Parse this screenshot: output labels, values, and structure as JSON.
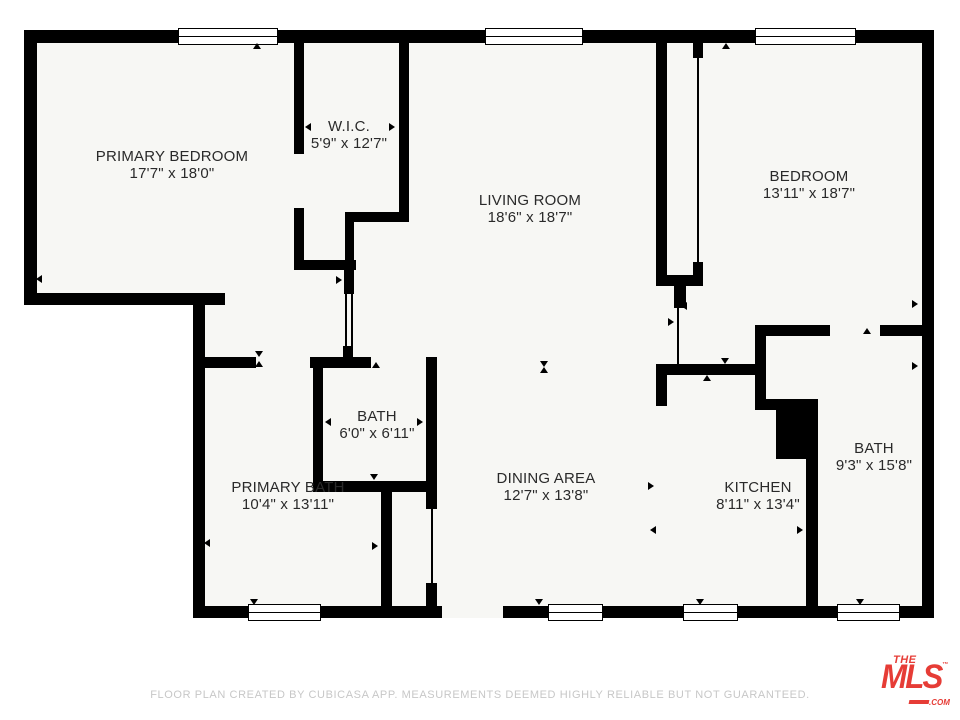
{
  "floorplan": {
    "rooms": [
      {
        "name": "PRIMARY BEDROOM",
        "dims": "17'7\" x 18'0\""
      },
      {
        "name": "W.I.C.",
        "dims": "5'9\" x 12'7\""
      },
      {
        "name": "LIVING ROOM",
        "dims": "18'6\" x 18'7\""
      },
      {
        "name": "BEDROOM",
        "dims": "13'11\" x 18'7\""
      },
      {
        "name": "BATH",
        "dims": "6'0\" x 6'11\""
      },
      {
        "name": "PRIMARY BATH",
        "dims": "10'4\" x 13'11\""
      },
      {
        "name": "DINING AREA",
        "dims": "12'7\" x 13'8\""
      },
      {
        "name": "KITCHEN",
        "dims": "8'11\" x 13'4\""
      },
      {
        "name": "BATH",
        "dims": "9'3\" x 15'8\""
      }
    ],
    "footer": "FLOOR PLAN CREATED BY CUBICASA APP. MEASUREMENTS DEEMED HIGHLY RELIABLE BUT NOT GUARANTEED.",
    "logo": {
      "the": "THE",
      "mls": "MLS",
      "tm": "™",
      "com": ".COM",
      "color": "#e63c36"
    },
    "colors": {
      "wall": "#000000",
      "floor": "#f7f7f4",
      "footer_text": "#c7c7c7"
    }
  }
}
